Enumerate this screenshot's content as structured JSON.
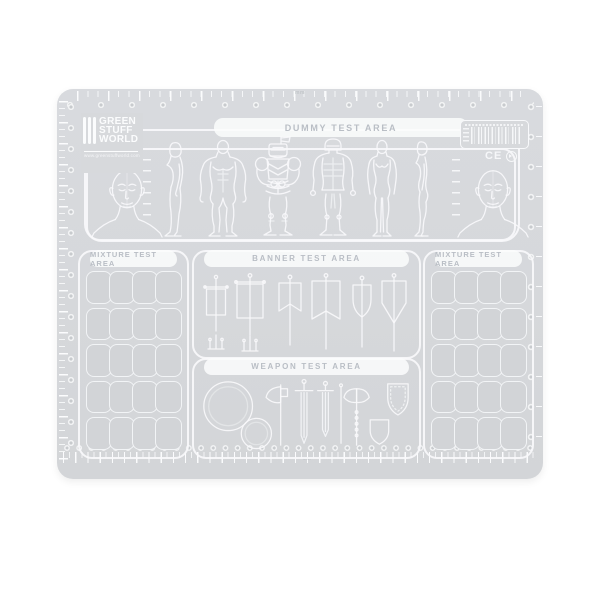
{
  "logo": {
    "line1": "GREEN",
    "line2": "STUFF",
    "line3": "WORLD",
    "website": "www.greenstuffworld.com"
  },
  "areas": {
    "dummy": "DUMMY TEST AREA",
    "mixture_left": "MIXTURE TEST AREA",
    "banner": "BANNER TEST AREA",
    "weapon": "WEAPON TEST AREA",
    "mixture_right": "MIXTURE TEST AREA"
  },
  "marks": {
    "ce": "CE"
  },
  "ruler": {
    "top_unit": "mm",
    "bottom_unit": "cm"
  },
  "mixture_grid": {
    "rows": 5,
    "cells_per_row": 4
  },
  "colors": {
    "page_background": "#ffffff",
    "mat": "#d7d9dc",
    "line": "#f6f7f9",
    "label": "#b9bec5",
    "cell": "#d2d4d7"
  }
}
